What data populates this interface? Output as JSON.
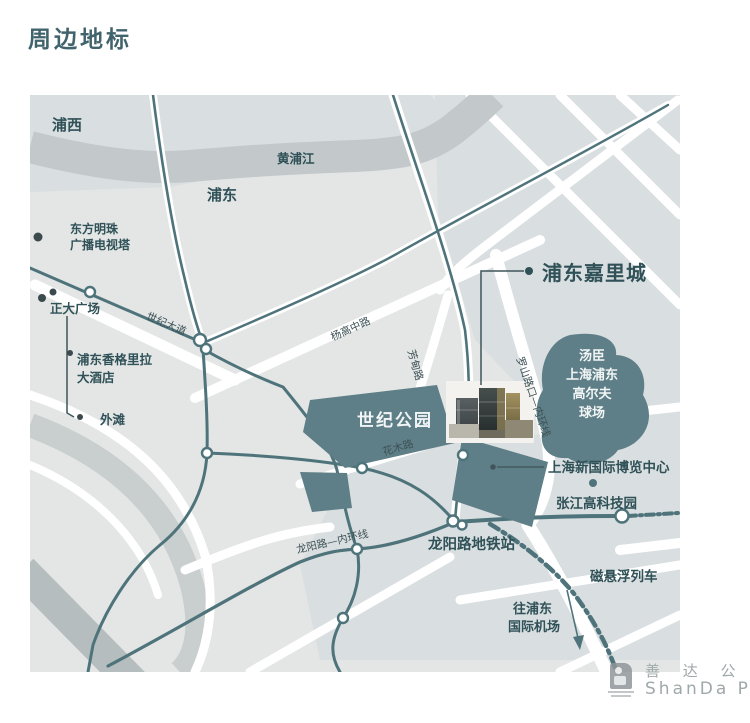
{
  "page": {
    "title": "周边地标"
  },
  "map": {
    "region_labels": {
      "puxi": "浦西",
      "pudong": "浦东"
    },
    "river_label": "黄浦江",
    "roads": {
      "century_avenue": "世纪大道",
      "yanggao_middle": "杨高中路",
      "fangdian": "芳甸路",
      "luoshan": "罗山路口—内环线",
      "huamu": "花木路",
      "longyang": "龙阳路—内环线"
    },
    "landmarks": {
      "oriental_pearl": {
        "lines": [
          "东方明珠",
          "广播电视塔"
        ]
      },
      "zhengda": {
        "label": "正大广场"
      },
      "shangrila": {
        "lines": [
          "浦东香格里拉",
          "大酒店"
        ]
      },
      "bund": {
        "label": "外滩"
      },
      "kerry": {
        "label": "浦东嘉里城"
      },
      "century_park": {
        "label": "世纪公园"
      },
      "golf": {
        "lines": [
          "汤臣",
          "上海浦东",
          "高尔夫",
          "球场"
        ]
      },
      "expo": {
        "label": "上海新国际博览中心"
      },
      "zhangjiang": {
        "label": "张江高科技园"
      },
      "longyang_station": {
        "label": "龙阳路地铁站"
      },
      "maglev": {
        "label": "磁悬浮列车"
      },
      "airport": {
        "lines": [
          "往浦东",
          "国际机场"
        ]
      }
    },
    "colors": {
      "road_teal": "#4e737a",
      "park_fill": "#5e7f87",
      "river_fill": "#c3c9cb",
      "block_fill": "#d9dee0",
      "base_fill": "#e3e6e5",
      "label_dark": "#2f5157",
      "title_color": "#41646c",
      "watermark_gray": "#9fa8aa"
    }
  },
  "watermark": {
    "cn": "善 达 公 关",
    "en": "ShanDa PR"
  }
}
